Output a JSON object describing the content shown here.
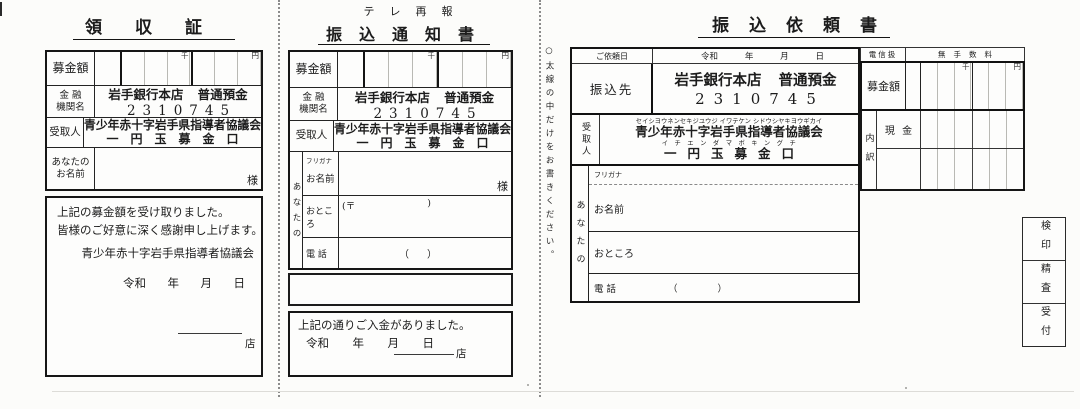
{
  "receipt": {
    "title": "領収証",
    "amount": {
      "label": "募金額",
      "thousand": "千",
      "yen": "円"
    },
    "bank": {
      "label1": "金 融",
      "label2": "機関名",
      "value1": "岩手銀行本店 普通預金",
      "value2": "2310745"
    },
    "payee": {
      "label": "受取人",
      "value1": "青少年赤十字岩手県指導者協議会",
      "value2": "一円玉募金口"
    },
    "name": {
      "label1": "あなたの",
      "label2": "お名前",
      "suffix": "様"
    },
    "message1": "上記の募金額を受け取りました。",
    "message2": "皆様のご好意に深く感謝申し上げます。",
    "org": "青少年赤十字岩手県指導者協議会",
    "era": "令和",
    "year": "年",
    "month": "月",
    "day": "日",
    "branch": "店"
  },
  "notice": {
    "header": "テレ再報",
    "title": "振込通知書",
    "amount": {
      "label": "募金額",
      "thousand": "千",
      "yen": "円"
    },
    "bank": {
      "label1": "金 融",
      "label2": "機関名",
      "value1": "岩手銀行本店 普通預金",
      "value2": "2310745"
    },
    "payee": {
      "label": "受取人",
      "value1": "青少年赤十字岩手県指導者協議会",
      "value2": "一円玉募金口"
    },
    "you": "あなたの",
    "furigana": "フリガナ",
    "name_label": "お名前",
    "name_suffix": "様",
    "address_label": "おところ",
    "postal_open": "(〒",
    "postal_close": ")",
    "phone_label": "電 話",
    "paren_open": "（",
    "paren_close": "）",
    "footer": {
      "message": "上記の通りご入金がありました。",
      "era": "令和",
      "year": "年",
      "month": "月",
      "day": "日",
      "branch": "店"
    }
  },
  "request": {
    "title": "振込依頼書",
    "side_note": "○太線の中だけをお書きください。",
    "request_date_label": "ご依頼日",
    "era": "令和",
    "year": "年",
    "month": "月",
    "day": "日",
    "destination": {
      "label": "振込先",
      "value1": "岩手銀行本店 普通預金",
      "value2": "2310745"
    },
    "payee": {
      "label": "受取人",
      "kana1": "セイシヨウネンセキジユウジ イワテケン シドウシヤキヨウギカイ",
      "value1": "青少年赤十字岩手県指導者協議会",
      "kana2": "イチエンダマボキングチ",
      "value2": "一円玉募金口"
    },
    "telegraph": "電信扱",
    "no_fee": "無手数料",
    "amount": {
      "label": "募金額",
      "thousand": "千",
      "yen": "円"
    },
    "breakdown": {
      "label": "内訳",
      "cash": "現 金"
    },
    "you": "あなたの",
    "furigana": "フリガナ",
    "name_label": "お名前",
    "address_label": "おところ",
    "phone_label": "電 話",
    "paren_open": "（",
    "paren_close": "）",
    "stamps": [
      {
        "label": "検印"
      },
      {
        "label": "精査"
      },
      {
        "label": "受付"
      }
    ]
  }
}
